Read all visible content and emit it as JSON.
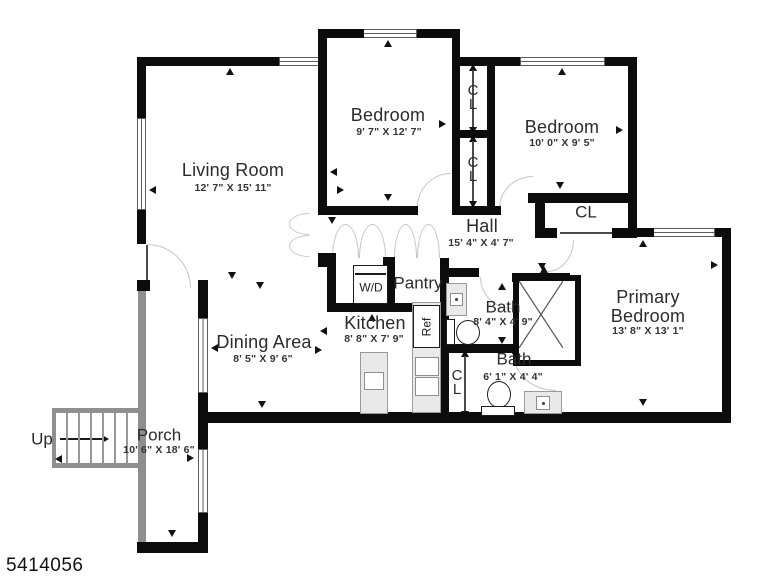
{
  "plan_id": "5414056",
  "rooms": {
    "living_room": {
      "name": "Living Room",
      "dims": "12' 7\" X 15' 11\""
    },
    "bedroom_top": {
      "name": "Bedroom",
      "dims": "9' 7\" X 12' 7\""
    },
    "bedroom_right": {
      "name": "Bedroom",
      "dims": "10' 0\" X 9' 5\""
    },
    "primary_bedroom": {
      "name": "Primary Bedroom",
      "dims": "13' 8\" X 13' 1\""
    },
    "hall": {
      "name": "Hall",
      "dims": "15' 4\" X 4' 7\""
    },
    "dining_area": {
      "name": "Dining Area",
      "dims": "8' 5\" X 9' 6\""
    },
    "kitchen": {
      "name": "Kitchen",
      "dims": "8' 8\" X 7' 9\""
    },
    "bath_upper": {
      "name": "Bath",
      "dims": "8' 4\" X 4' 9\""
    },
    "bath_lower": {
      "name": "Bath",
      "dims": "6' 1\" X 4' 4\""
    },
    "porch": {
      "name": "Porch",
      "dims": "10' 6\" X 18' 6\""
    },
    "pantry": {
      "name": "Pantry"
    }
  },
  "labels": {
    "closet": "CL",
    "washer_dryer": "W/D",
    "refrigerator": "Ref",
    "stairs_up": "Up"
  }
}
